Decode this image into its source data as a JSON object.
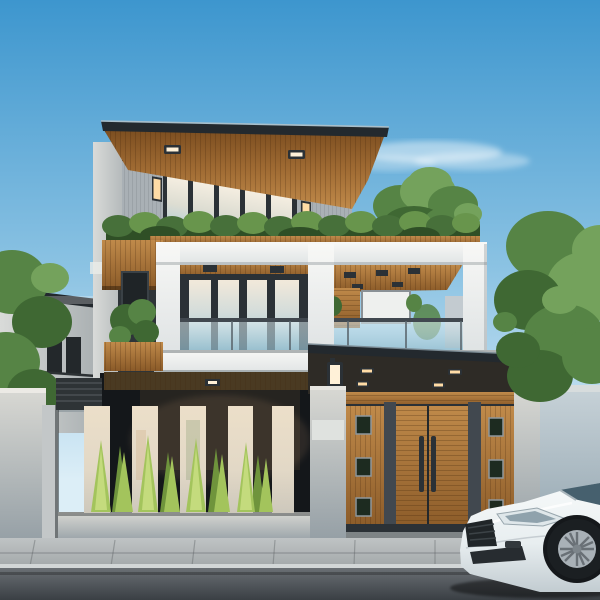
{
  "meta": {
    "title": "Photorealistic rendering of a modern three-story house at dusk",
    "description": "Modern villa with cantilevered wood-slat roofs, white box balcony frame, glass railings, hedge planters, slatted entrance gate with canopy and lanterns, white fence panels with conifers, trees, and a white sedan parked on the street"
  },
  "palette": {
    "skyTop": "#3d96ce",
    "skyMid": "#8cc3e3",
    "skyLow": "#dceef7",
    "cloud": "#ffffff",
    "fascia": "#23292e",
    "woodLight": "#c08a4a",
    "wood": "#a06b33",
    "woodDark": "#7c4e20",
    "woodDeep": "#5e3a16",
    "frameDark": "#2b3136",
    "frameMid": "#41484f",
    "siding": "#a9b0b5",
    "sidingShade": "#8d959b",
    "creamGlass": "#f2e9d8",
    "warmGlass": "#f4eee3",
    "blueGlass": "#aecdd8",
    "whiteWall": "#f6f6f4",
    "whiteShade": "#e2e6e7",
    "whiteDark": "#c3cbd0",
    "hedgeDark": "#2f4f26",
    "hedge": "#47703a",
    "hedgeLight": "#68954c",
    "treeDark": "#3f6833",
    "tree": "#568445",
    "treeLight": "#74a25c",
    "conifer": "#a3c45c",
    "coniferLight": "#c4db7d",
    "coniferDark": "#6f943c",
    "concreteLight": "#d8d8d3",
    "concrete": "#bec7cb",
    "concreteDark": "#97a3ab",
    "fencePanelTop": "#ecdfc9",
    "fencePanelBot": "#cdc8bc",
    "lampGlow": "#ffdca6",
    "lampGlowHot": "#fff1d8",
    "canopyDark": "#2e2b26",
    "entranceDark": "#14171a",
    "sidewalk": "#b5b9ba",
    "curb": "#d2d6d7",
    "road": "#585d62",
    "roadDark": "#3a3f44",
    "carWhite": "#f4f7f8",
    "carShade": "#d9e0e3",
    "carDark": "#b6bfc5",
    "tire": "#1b1f22",
    "rim": "#a9b1b7",
    "windshield": "#46606e"
  },
  "scene": {
    "objects": [
      "blue sky with faint cloud",
      "cantilevered wood-slat roof with recessed lights",
      "clerestory windows",
      "third-floor glass doors with warm interior light",
      "wall sconces glowing",
      "balcony hedge planter",
      "white box frame balcony with glass railing",
      "second-floor glass sliding doors",
      "open roof terrace with wood ceiling lights",
      "gate canopy with downlights and lanterns",
      "slatted wooden entry gate",
      "white fence panels with conifer plants",
      "concrete boundary walls",
      "neighboring gray house",
      "green trees",
      "white sedan parked on street",
      "sidewalk and asphalt road"
    ]
  }
}
